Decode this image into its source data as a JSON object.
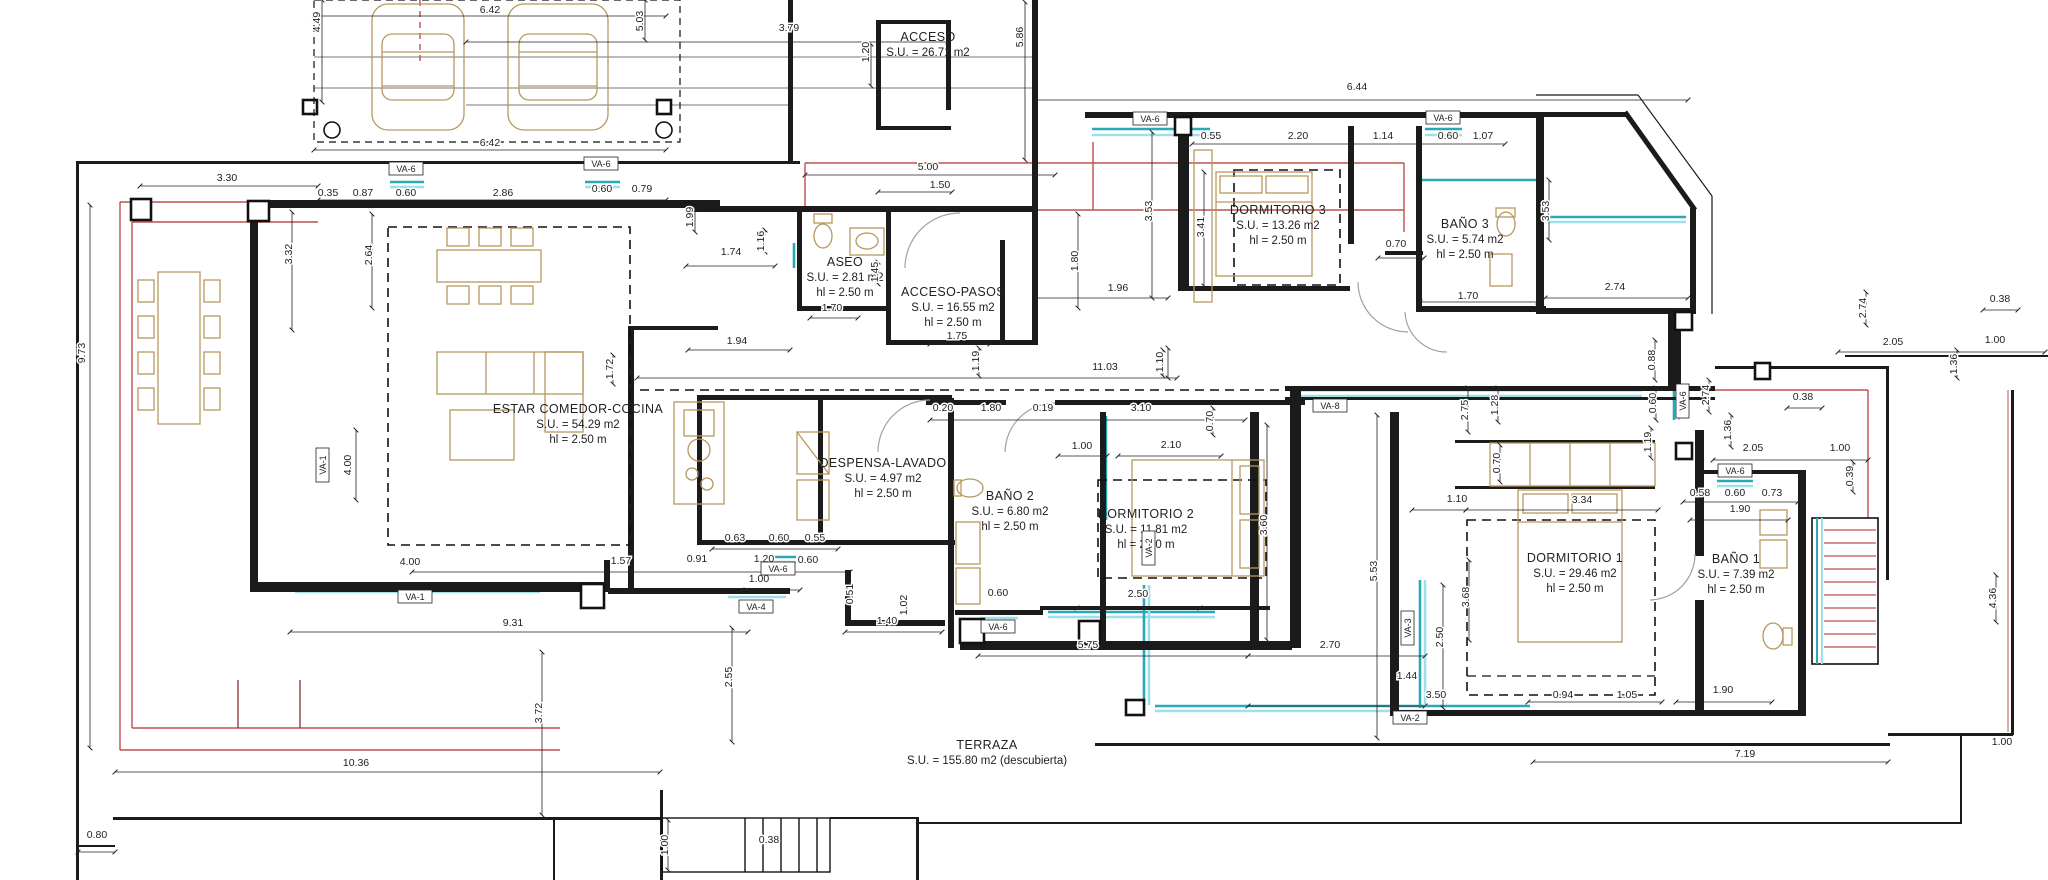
{
  "drawing": {
    "type": "architectural floor plan",
    "terrace_note": "(descubierta)"
  },
  "colors": {
    "wall": "#1b1b1b",
    "thin_line": "#555555",
    "red_line": "#c0504d",
    "window_teal": "#2aa8b8",
    "window_teal_light": "#9fdfe8",
    "furniture_tan": "#b7975f",
    "door_arc": "#9aa4a8",
    "dashed_boundary": "#111111"
  },
  "rooms": [
    {
      "id": "acceso",
      "x": 928,
      "y": 41,
      "lines": [
        "ACCESO",
        "S.U. = 26.71 m2"
      ]
    },
    {
      "id": "aseo",
      "x": 845,
      "y": 266,
      "lines": [
        "ASEO",
        "S.U. = 2.81 m2",
        "hl = 2.50 m"
      ]
    },
    {
      "id": "acceso-pasos",
      "x": 953,
      "y": 296,
      "lines": [
        "ACCESO-PASOS",
        "S.U. = 16.55 m2",
        "hl = 2.50 m"
      ]
    },
    {
      "id": "estar-comedor-cocina",
      "x": 578,
      "y": 413,
      "lines": [
        "ESTAR COMEDOR-COCINA",
        "S.U. = 54.29 m2",
        "hl = 2.50 m"
      ]
    },
    {
      "id": "despensa-lavado",
      "x": 883,
      "y": 467,
      "lines": [
        "DESPENSA-LAVADO",
        "S.U. = 4.97 m2",
        "hl = 2.50 m"
      ]
    },
    {
      "id": "bano2",
      "x": 1010,
      "y": 500,
      "lines": [
        "BAÑO 2",
        "S.U. = 6.80 m2",
        "hl = 2.50 m"
      ]
    },
    {
      "id": "dormitorio2",
      "x": 1146,
      "y": 518,
      "lines": [
        "DORMITORIO 2",
        "S.U. = 11.81 m2",
        "hl = 2.50 m"
      ]
    },
    {
      "id": "dormitorio3",
      "x": 1278,
      "y": 214,
      "lines": [
        "DORMITORIO 3",
        "S.U. = 13.26 m2",
        "hl = 2.50 m"
      ]
    },
    {
      "id": "bano3",
      "x": 1465,
      "y": 228,
      "lines": [
        "BAÑO 3",
        "S.U. = 5.74 m2",
        "hl = 2.50 m"
      ]
    },
    {
      "id": "dormitorio1",
      "x": 1575,
      "y": 562,
      "lines": [
        "DORMITORIO 1",
        "S.U. = 29.46 m2",
        "hl = 2.50 m"
      ]
    },
    {
      "id": "bano1",
      "x": 1736,
      "y": 563,
      "lines": [
        "BAÑO 1",
        "S.U. = 7.39 m2",
        "hl = 2.50 m"
      ]
    },
    {
      "id": "terraza",
      "x": 987,
      "y": 749,
      "lines": [
        "TERRAZA",
        "S.U. = 155.80 m2 (descubierta)"
      ]
    }
  ],
  "dimensions": [
    {
      "t": "6.42",
      "x": 490,
      "y": 13
    },
    {
      "t": "4.49",
      "x": 320,
      "y": 22,
      "v": 1
    },
    {
      "t": "5.03",
      "x": 643,
      "y": 21,
      "v": 1
    },
    {
      "t": "3.79",
      "x": 789,
      "y": 31
    },
    {
      "t": "1.20",
      "x": 869,
      "y": 52,
      "v": 1
    },
    {
      "t": "5.86",
      "x": 1023,
      "y": 37,
      "v": 1
    },
    {
      "t": "6.42",
      "x": 490,
      "y": 146
    },
    {
      "t": "6.44",
      "x": 1357,
      "y": 90
    },
    {
      "t": "3.30",
      "x": 227,
      "y": 181
    },
    {
      "t": "0.35",
      "x": 328,
      "y": 196
    },
    {
      "t": "0.87",
      "x": 363,
      "y": 196
    },
    {
      "t": "0.60",
      "x": 406,
      "y": 196
    },
    {
      "t": "2.86",
      "x": 503,
      "y": 196
    },
    {
      "t": "0.60",
      "x": 602,
      "y": 192
    },
    {
      "t": "0.79",
      "x": 642,
      "y": 192
    },
    {
      "t": "5.00",
      "x": 928,
      "y": 170
    },
    {
      "t": "1.50",
      "x": 940,
      "y": 188
    },
    {
      "t": "0.55",
      "x": 1211,
      "y": 139
    },
    {
      "t": "2.20",
      "x": 1298,
      "y": 139
    },
    {
      "t": "1.14",
      "x": 1383,
      "y": 139
    },
    {
      "t": "0.60",
      "x": 1448,
      "y": 139
    },
    {
      "t": "1.07",
      "x": 1483,
      "y": 139
    },
    {
      "t": "3.32",
      "x": 292,
      "y": 254,
      "v": 1
    },
    {
      "t": "2.64",
      "x": 372,
      "y": 255,
      "v": 1
    },
    {
      "t": "9.73",
      "x": 85,
      "y": 353,
      "v": 1
    },
    {
      "t": "1.99",
      "x": 693,
      "y": 217,
      "v": 1
    },
    {
      "t": "1.74",
      "x": 731,
      "y": 255
    },
    {
      "t": "1.16",
      "x": 764,
      "y": 241,
      "v": 1
    },
    {
      "t": "1.45",
      "x": 878,
      "y": 272,
      "v": 1
    },
    {
      "t": "1.70",
      "x": 832,
      "y": 311
    },
    {
      "t": "1.75",
      "x": 957,
      "y": 339
    },
    {
      "t": "1.19",
      "x": 979,
      "y": 361,
      "v": 1
    },
    {
      "t": "1.94",
      "x": 737,
      "y": 344
    },
    {
      "t": "3.53",
      "x": 1152,
      "y": 211,
      "v": 1
    },
    {
      "t": "3.41",
      "x": 1204,
      "y": 227,
      "v": 1
    },
    {
      "t": "1.80",
      "x": 1078,
      "y": 261,
      "v": 1
    },
    {
      "t": "1.96",
      "x": 1118,
      "y": 291
    },
    {
      "t": "0.70",
      "x": 1396,
      "y": 247
    },
    {
      "t": "1.70",
      "x": 1468,
      "y": 299
    },
    {
      "t": "2.74",
      "x": 1615,
      "y": 290
    },
    {
      "t": "3.53",
      "x": 1549,
      "y": 211,
      "v": 1
    },
    {
      "t": "11.03",
      "x": 1105,
      "y": 370
    },
    {
      "t": "1.10",
      "x": 1163,
      "y": 362,
      "v": 1
    },
    {
      "t": "0.20",
      "x": 943,
      "y": 411
    },
    {
      "t": "1.80",
      "x": 991,
      "y": 411
    },
    {
      "t": "0.19",
      "x": 1043,
      "y": 411
    },
    {
      "t": "3.10",
      "x": 1141,
      "y": 411
    },
    {
      "t": "0.70",
      "x": 1213,
      "y": 421,
      "v": 1
    },
    {
      "t": "1.00",
      "x": 1082,
      "y": 449
    },
    {
      "t": "2.10",
      "x": 1171,
      "y": 448
    },
    {
      "t": "1.72",
      "x": 613,
      "y": 369,
      "v": 1
    },
    {
      "t": "4.00",
      "x": 351,
      "y": 465,
      "v": 1
    },
    {
      "t": "4.00",
      "x": 410,
      "y": 565
    },
    {
      "t": "1.57",
      "x": 621,
      "y": 564
    },
    {
      "t": "0.91",
      "x": 697,
      "y": 562
    },
    {
      "t": "1.20",
      "x": 764,
      "y": 562
    },
    {
      "t": "0.60",
      "x": 808,
      "y": 563
    },
    {
      "t": "1.00",
      "x": 759,
      "y": 582
    },
    {
      "t": "0.63",
      "x": 735,
      "y": 541
    },
    {
      "t": "0.60",
      "x": 779,
      "y": 541
    },
    {
      "t": "0.55",
      "x": 815,
      "y": 541
    },
    {
      "t": "0.51",
      "x": 853,
      "y": 594,
      "v": 1
    },
    {
      "t": "1.02",
      "x": 907,
      "y": 605,
      "v": 1
    },
    {
      "t": "1.40",
      "x": 887,
      "y": 624
    },
    {
      "t": "0.60",
      "x": 998,
      "y": 596
    },
    {
      "t": "2.50",
      "x": 1138,
      "y": 597
    },
    {
      "t": "2.55",
      "x": 732,
      "y": 677,
      "v": 1
    },
    {
      "t": "3.72",
      "x": 542,
      "y": 713,
      "v": 1
    },
    {
      "t": "9.31",
      "x": 513,
      "y": 626
    },
    {
      "t": "10.36",
      "x": 356,
      "y": 766
    },
    {
      "t": "0.80",
      "x": 97,
      "y": 838
    },
    {
      "t": "1.00",
      "x": 668,
      "y": 845,
      "v": 1
    },
    {
      "t": "0.38",
      "x": 769,
      "y": 843
    },
    {
      "t": "5.75",
      "x": 1088,
      "y": 648
    },
    {
      "t": "2.70",
      "x": 1330,
      "y": 648
    },
    {
      "t": "3.60",
      "x": 1267,
      "y": 525,
      "v": 1
    },
    {
      "t": "5.53",
      "x": 1377,
      "y": 571,
      "v": 1
    },
    {
      "t": "2.75",
      "x": 1468,
      "y": 410,
      "v": 1
    },
    {
      "t": "1.28",
      "x": 1498,
      "y": 405,
      "v": 1
    },
    {
      "t": "0.70",
      "x": 1500,
      "y": 463,
      "v": 1
    },
    {
      "t": "1.10",
      "x": 1457,
      "y": 502
    },
    {
      "t": "3.34",
      "x": 1582,
      "y": 503
    },
    {
      "t": "0.88",
      "x": 1655,
      "y": 360,
      "v": 1
    },
    {
      "t": "0.60",
      "x": 1656,
      "y": 403,
      "v": 1
    },
    {
      "t": "1.19",
      "x": 1651,
      "y": 442,
      "v": 1
    },
    {
      "t": "2.74",
      "x": 1709,
      "y": 395,
      "v": 1
    },
    {
      "t": "1.36",
      "x": 1731,
      "y": 430,
      "v": 1
    },
    {
      "t": "0.38",
      "x": 1803,
      "y": 400
    },
    {
      "t": "2.05",
      "x": 1753,
      "y": 451
    },
    {
      "t": "1.00",
      "x": 1840,
      "y": 451
    },
    {
      "t": "0.39",
      "x": 1853,
      "y": 476,
      "v": 1
    },
    {
      "t": "0.58",
      "x": 1700,
      "y": 496
    },
    {
      "t": "0.60",
      "x": 1735,
      "y": 496
    },
    {
      "t": "0.73",
      "x": 1772,
      "y": 496
    },
    {
      "t": "1.90",
      "x": 1740,
      "y": 512
    },
    {
      "t": "2.50",
      "x": 1443,
      "y": 637,
      "v": 1
    },
    {
      "t": "3.68",
      "x": 1469,
      "y": 597,
      "v": 1
    },
    {
      "t": "1.44",
      "x": 1407,
      "y": 679
    },
    {
      "t": "3.50",
      "x": 1436,
      "y": 698
    },
    {
      "t": "0.94",
      "x": 1563,
      "y": 698
    },
    {
      "t": "1.05",
      "x": 1627,
      "y": 698
    },
    {
      "t": "1.90",
      "x": 1723,
      "y": 693
    },
    {
      "t": "7.19",
      "x": 1745,
      "y": 757
    },
    {
      "t": "1.00",
      "x": 2002,
      "y": 745
    },
    {
      "t": "4.36",
      "x": 1996,
      "y": 598,
      "v": 1
    },
    {
      "t": "0.38",
      "x": 2000,
      "y": 302
    },
    {
      "t": "2.05",
      "x": 1893,
      "y": 345
    },
    {
      "t": "1.00",
      "x": 1995,
      "y": 343
    },
    {
      "t": "1.36",
      "x": 1957,
      "y": 364,
      "v": 1
    },
    {
      "t": "2.74",
      "x": 1866,
      "y": 308,
      "v": 1
    }
  ],
  "window_labels": [
    {
      "t": "VA-6",
      "x": 406,
      "y": 172
    },
    {
      "t": "VA-6",
      "x": 601,
      "y": 167
    },
    {
      "t": "VA-6",
      "x": 1150,
      "y": 122
    },
    {
      "t": "VA-6",
      "x": 1443,
      "y": 121
    },
    {
      "t": "VA-8",
      "x": 1330,
      "y": 409
    },
    {
      "t": "VA-6",
      "x": 1735,
      "y": 474
    },
    {
      "t": "VA-1",
      "x": 415,
      "y": 600
    },
    {
      "t": "VA-4",
      "x": 756,
      "y": 610
    },
    {
      "t": "VA-6",
      "x": 778,
      "y": 572
    },
    {
      "t": "VA-6",
      "x": 998,
      "y": 630
    },
    {
      "t": "VA-2",
      "x": 1410,
      "y": 721
    },
    {
      "t": "VA-3",
      "x": 1411,
      "y": 628,
      "v": 1
    },
    {
      "t": "VA-6",
      "x": 1686,
      "y": 401,
      "v": 1
    },
    {
      "t": "VA-1",
      "x": 326,
      "y": 465,
      "v": 1
    },
    {
      "t": "VA-2",
      "x": 1152,
      "y": 548,
      "v": 1
    }
  ]
}
